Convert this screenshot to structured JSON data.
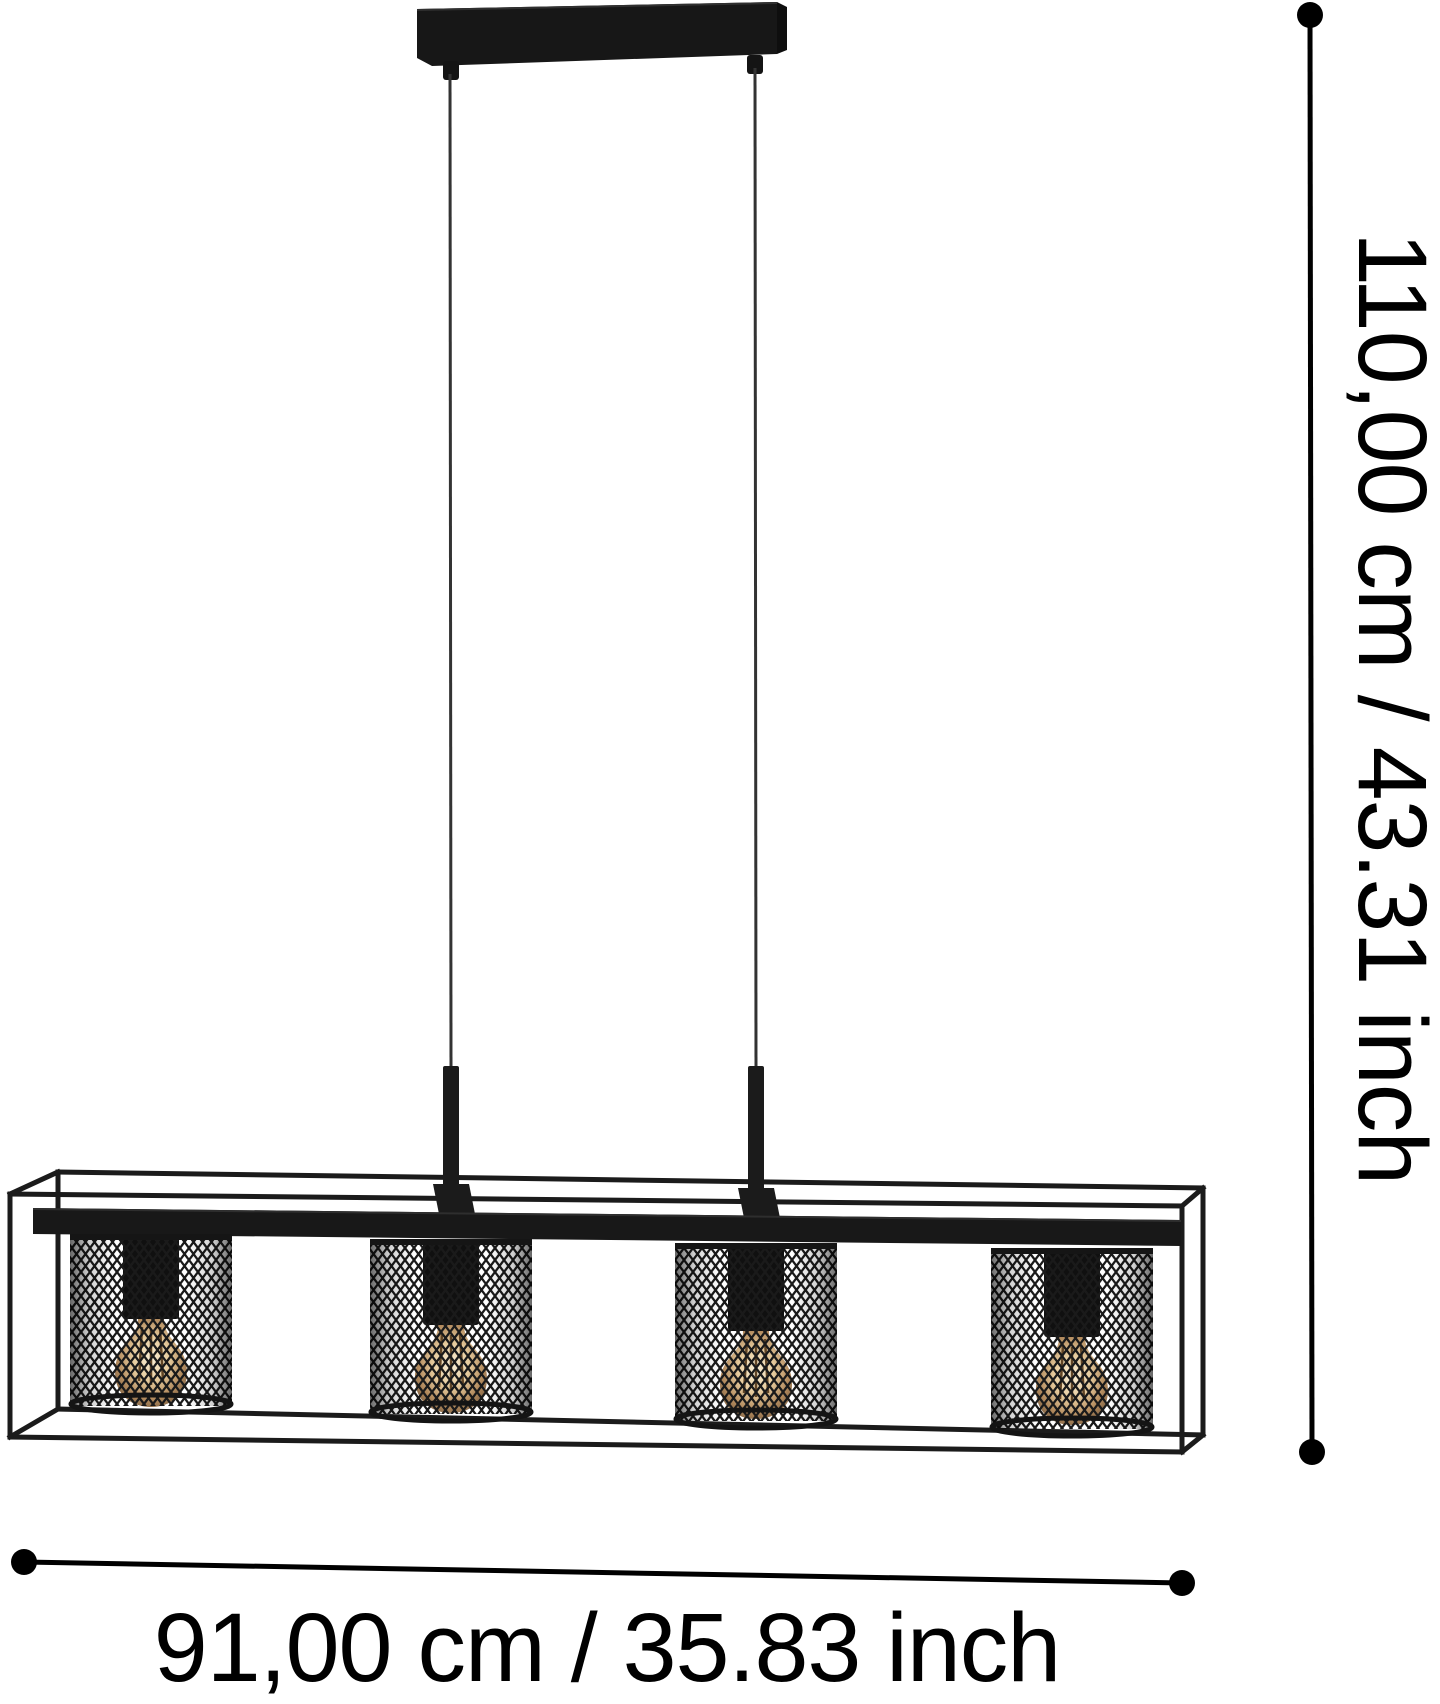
{
  "page": {
    "background_color": "#ffffff",
    "kind": "product dimension diagram"
  },
  "dimension_annotations": {
    "line_color": "#000000",
    "height": {
      "label": "110,00 cm / 43.31 inch",
      "orientation": "vertical"
    },
    "width": {
      "label": "91,00 cm / 35.83 inch",
      "orientation": "horizontal"
    }
  },
  "lamp": {
    "shade_count": 4,
    "colors": {
      "frame": "#1b1b1b",
      "canopy": "#171717",
      "canopy_side": "#0e0e0e",
      "cable": "#333333",
      "beam": "#181818",
      "socket": "#101010",
      "mesh": "#1a1a1a",
      "bulb_center": "#f8eed6",
      "bulb_mid": "#e6cb9d",
      "bulb_edge": "#7b5f42",
      "filament": "#5f4426"
    }
  }
}
